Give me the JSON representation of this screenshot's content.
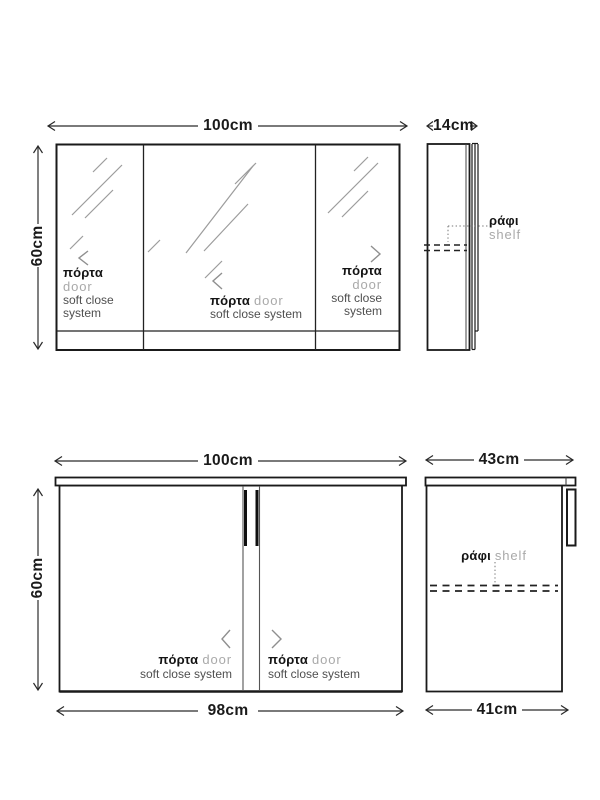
{
  "palette": {
    "background": "#ffffff",
    "outline": "#1a1a1a",
    "secondary_line": "#555555",
    "shine_line": "#9c9c9c",
    "greek_label_text": "#141414",
    "english_label_text": "#a9a9a9",
    "feature_text": "#4f4f4f"
  },
  "mirror_cabinet": {
    "front": {
      "width": "100cm",
      "height": "60cm",
      "doors": {
        "left": {
          "label_el": "πόρτα",
          "label_en": "door",
          "feature_line1": "soft close",
          "feature_line2": "system"
        },
        "middle": {
          "label_el": "πόρτα",
          "label_en": "door",
          "feature": "soft close system"
        },
        "right": {
          "label_el": "πόρτα",
          "label_en": "door",
          "feature_line1": "soft close",
          "feature_line2": "system"
        }
      }
    },
    "side": {
      "depth": "14cm",
      "shelf": {
        "label_el": "ράφι",
        "label_en": "shelf"
      }
    }
  },
  "base_cabinet": {
    "front": {
      "width_top": "100cm",
      "width_bottom": "98cm",
      "height": "60cm",
      "doors": {
        "left": {
          "label_el": "πόρτα",
          "label_en": "door",
          "feature": "soft close system"
        },
        "right": {
          "label_el": "πόρτα",
          "label_en": "door",
          "feature": "soft close system"
        }
      }
    },
    "side": {
      "depth_top": "43cm",
      "depth_bottom": "41cm",
      "shelf": {
        "label_el": "ράφι",
        "label_en": "shelf"
      }
    }
  }
}
